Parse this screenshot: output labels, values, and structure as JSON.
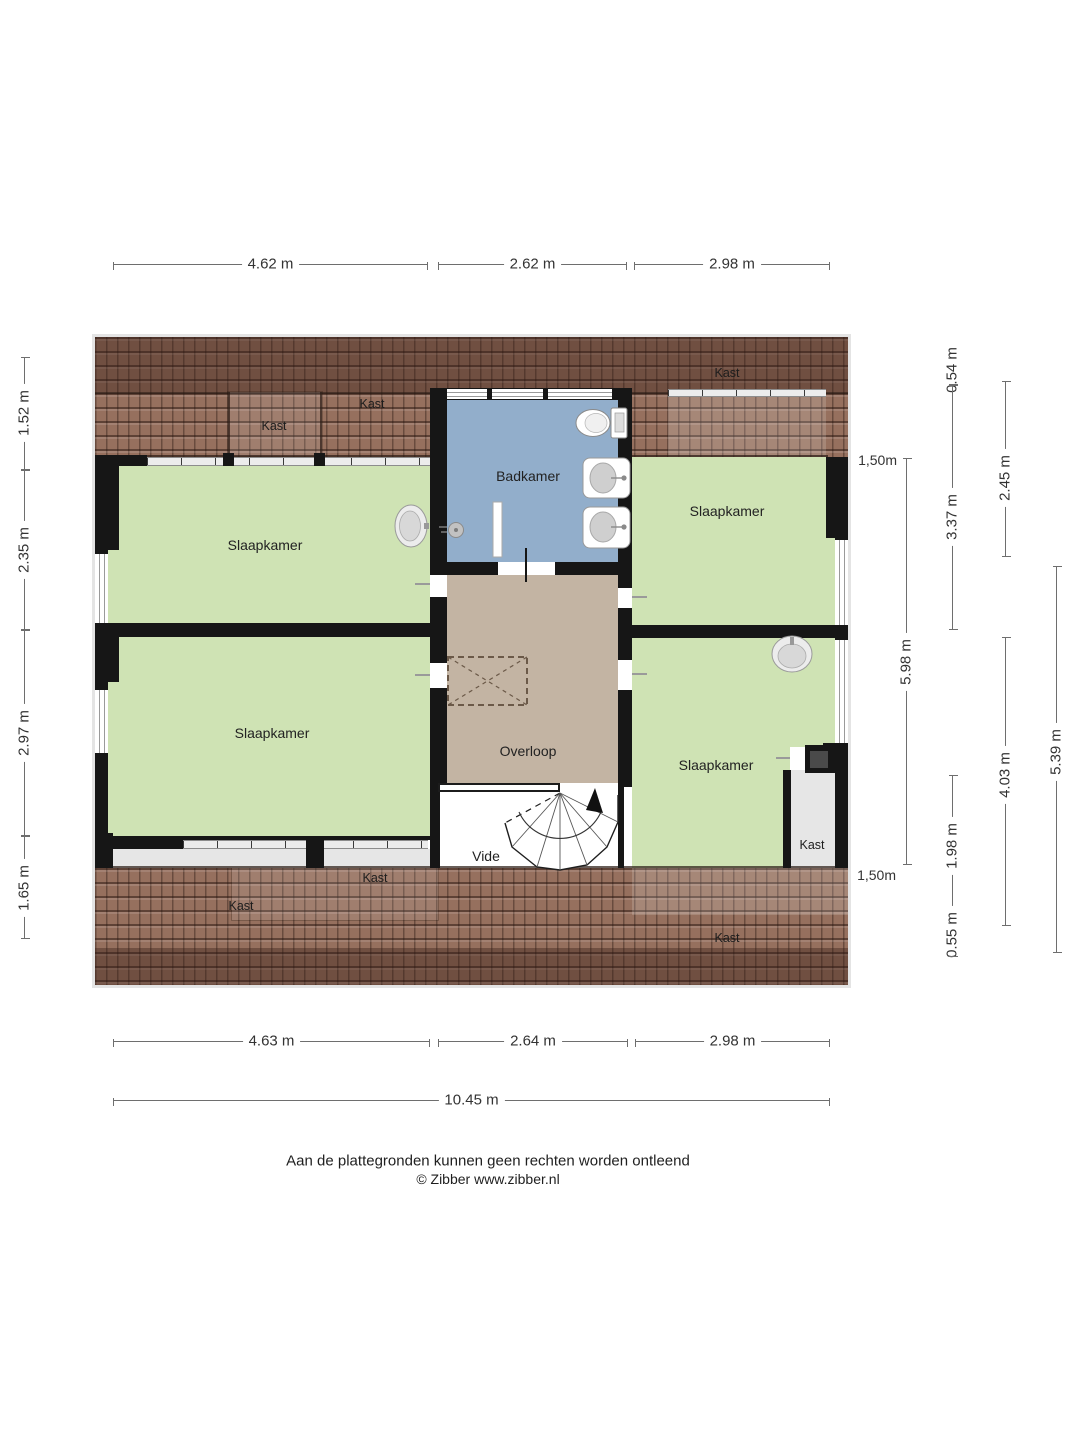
{
  "rooms": {
    "slaapkamer": "Slaapkamer",
    "badkamer": "Badkamer",
    "overloop": "Overloop",
    "vide": "Vide",
    "kast": "Kast"
  },
  "dimensions": {
    "top": [
      "4.62 m",
      "2.62 m",
      "2.98 m"
    ],
    "bottom": [
      "4.63 m",
      "2.64 m",
      "2.98 m"
    ],
    "bottom_total": "10.45 m",
    "left": [
      "1.52 m",
      "2.35 m",
      "2.97 m",
      "1.65 m"
    ],
    "right_col1": {
      "length": "5.98 m",
      "markers": [
        "1,50m",
        "1,50m"
      ]
    },
    "right_col2": [
      "0.54 m",
      "3.37 m",
      "1.98 m",
      "0.55 m"
    ],
    "right_col3": [
      "2.45 m",
      "4.03 m"
    ],
    "right_col4": [
      "5.39 m"
    ]
  },
  "footer": {
    "line1": "Aan de plattegronden kunnen geen rechten worden ontleend",
    "line2": "© Zibber www.zibber.nl"
  },
  "colors": {
    "roof": "#96705e",
    "bedroom_floor": "#cfe3b4",
    "bathroom_floor": "#92aecb",
    "landing_floor": "#c3b4a3",
    "closet_floor": "#e6e6e6",
    "wall": "#161616"
  }
}
